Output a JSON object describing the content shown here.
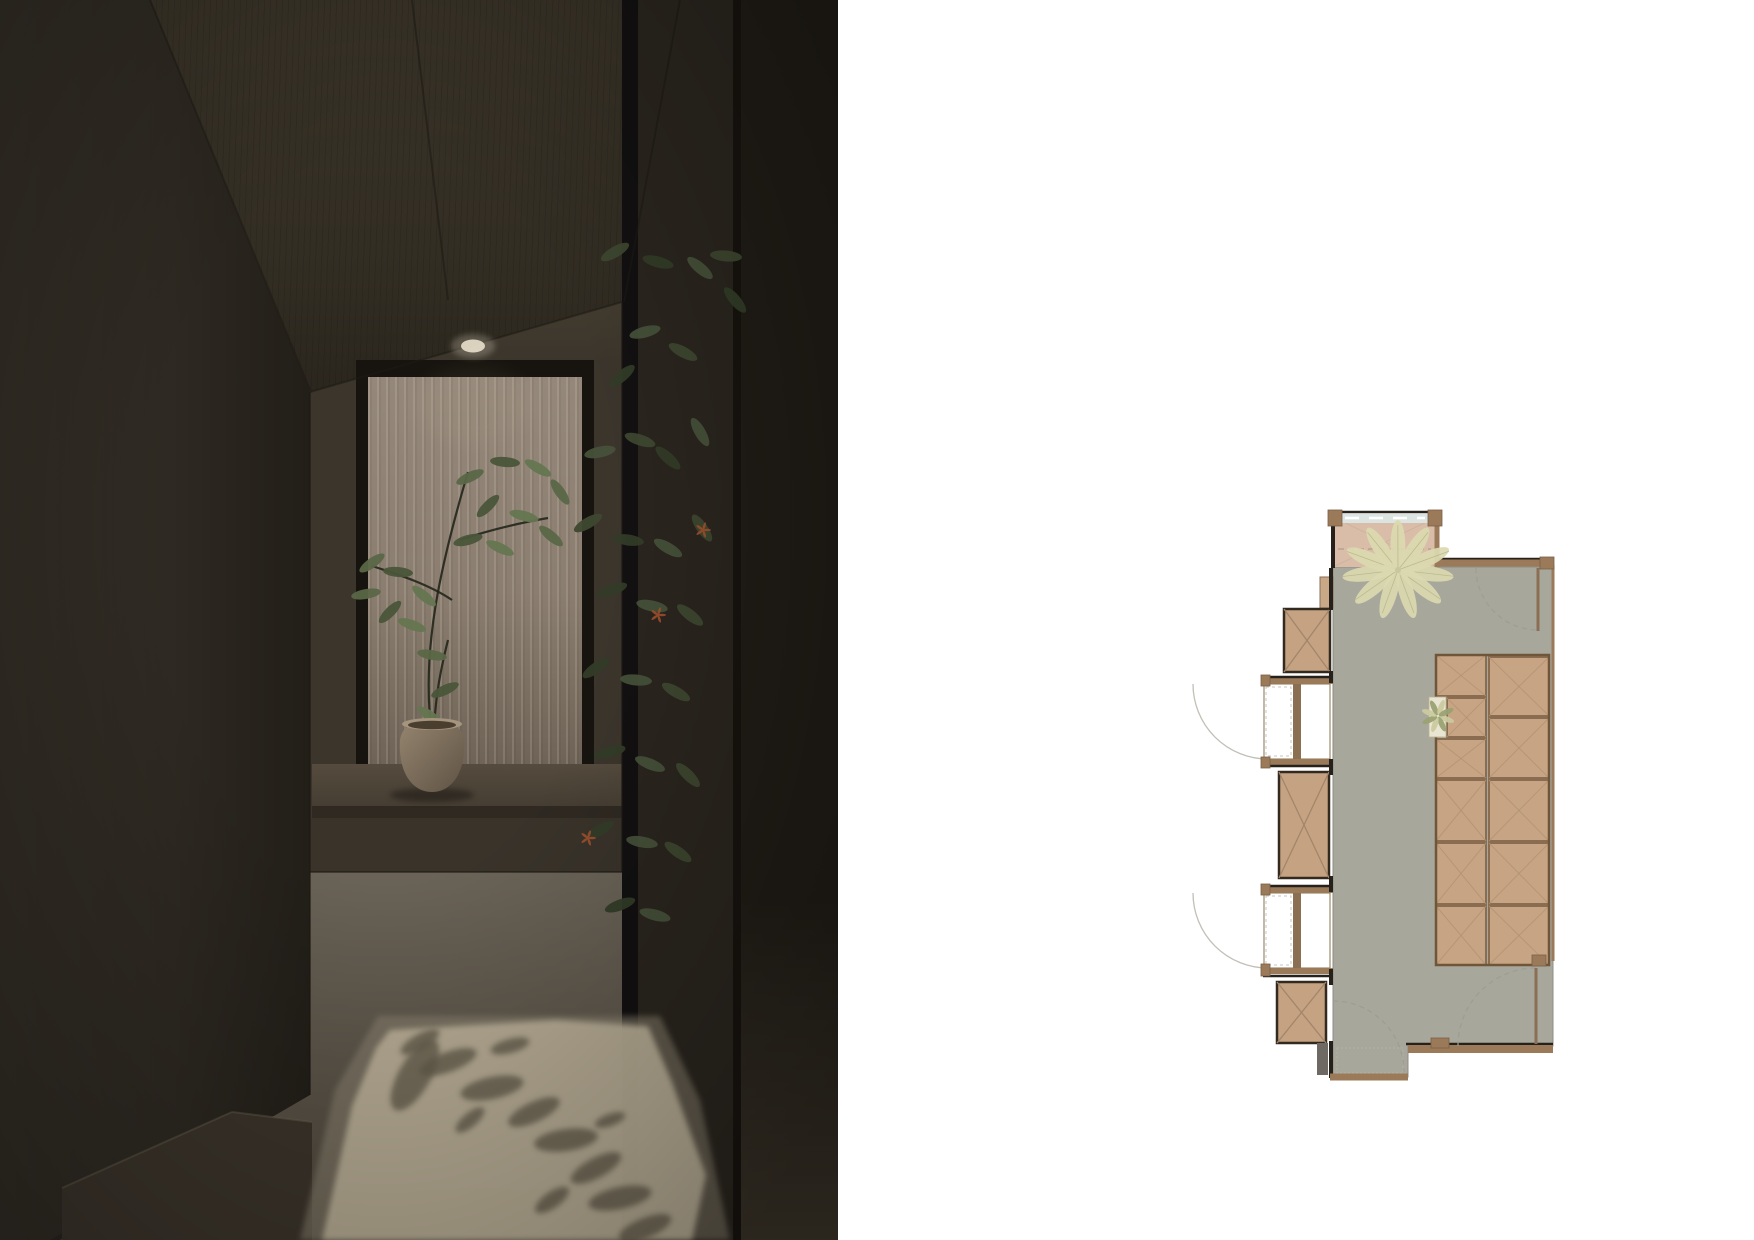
{
  "palette": {
    "plan_floor": "#a8a79c",
    "plan_entry": "#d9bda9",
    "plan_tan": "#c6a484",
    "plan_tan_border": "#8a6d50",
    "plan_block_outline": "#32291f",
    "plan_wall_brown": "#9b7a5a",
    "plan_wall_dark": "#26211b",
    "plan_alcove": "#ffffff",
    "plan_mullion": "#8a6f52",
    "plan_arc": "#c2bfb7",
    "plan_dash": "#a09c93",
    "plan_window_band": "#dce4e1",
    "plan_star_fill": "#dbd9b0",
    "plan_star_stroke": "#b5b384",
    "plan_stub": "#6e6a63",
    "render_lit_patch": "#b9ae96",
    "render_dim_patch": "#8d8472",
    "render_shadow": "#645c4c",
    "render_light": "#e8e0cb",
    "render_pot_light": "#94846f",
    "render_pot_dark": "#605344",
    "render_pot_rim": "#a5947e",
    "render_soil": "#4a3e2f",
    "render_flower": "#a0512c",
    "render_leaf_dark": "#333c28",
    "render_leaf_mid": "#3e4830",
    "render_leaf_light": "#46513a",
    "wplant_a": "#5a6747",
    "wplant_b": "#4a5539",
    "wplant_c": "#657650"
  },
  "render": {
    "size": [
      838,
      1240
    ],
    "downlight": {
      "cx": 473,
      "cy": 346
    },
    "corner_lines": [
      [
        150,
        0,
        310,
        390
      ],
      [
        412,
        0,
        448,
        300
      ],
      [
        680,
        0,
        624,
        302
      ],
      [
        310,
        392,
        622,
        302
      ],
      [
        310,
        392,
        310,
        1095
      ],
      [
        622,
        302,
        622,
        872
      ],
      [
        310,
        872,
        622,
        872
      ]
    ],
    "step_lines": [
      [
        62,
        1188,
        232,
        1112
      ],
      [
        232,
        1112,
        312,
        1122
      ]
    ],
    "dim_patch": "378,1016 660,1016 700,1100 730,1240 300,1240 335,1090",
    "lit_patch": "390,1030 556,1020 648,1026 672,1082 706,1175 692,1240 322,1240 352,1106 376,1048",
    "shadow_blobs": [
      [
        448,
        1062,
        30,
        10,
        -20
      ],
      [
        492,
        1088,
        32,
        11,
        -12
      ],
      [
        534,
        1112,
        28,
        10,
        -25
      ],
      [
        566,
        1140,
        32,
        11,
        -8
      ],
      [
        596,
        1168,
        28,
        10,
        -28
      ],
      [
        620,
        1198,
        32,
        11,
        -12
      ],
      [
        645,
        1228,
        28,
        10,
        -22
      ],
      [
        420,
        1042,
        22,
        8,
        -30
      ],
      [
        510,
        1046,
        20,
        7,
        -15
      ],
      [
        470,
        1120,
        18,
        7,
        -40
      ],
      [
        552,
        1200,
        20,
        8,
        -35
      ],
      [
        610,
        1120,
        16,
        6,
        -20
      ],
      [
        415,
        1075,
        40,
        16,
        -60
      ]
    ],
    "stems": [
      "M432,735 C420,650 442,560 468,472",
      "M452,600 C430,585 400,575 372,566",
      "M460,540 C495,528 525,522 548,518",
      "M448,640 C438,680 436,700 434,726"
    ],
    "window_leaves": [
      [
        470,
        477,
        -25
      ],
      [
        505,
        462,
        5
      ],
      [
        538,
        468,
        30
      ],
      [
        560,
        492,
        55
      ],
      [
        488,
        506,
        -45
      ],
      [
        524,
        516,
        15
      ],
      [
        551,
        536,
        40
      ],
      [
        468,
        540,
        -15
      ],
      [
        500,
        548,
        25
      ],
      [
        372,
        563,
        -35
      ],
      [
        398,
        572,
        5
      ],
      [
        424,
        596,
        40
      ],
      [
        366,
        594,
        -10
      ],
      [
        390,
        612,
        -45
      ],
      [
        412,
        625,
        20
      ],
      [
        432,
        655,
        10
      ],
      [
        445,
        690,
        -25
      ],
      [
        430,
        716,
        35
      ]
    ],
    "pot": {
      "cx": 432,
      "rim_y": 724,
      "bottom_y": 792
    },
    "hanging_leaves": [
      [
        615,
        252,
        -30
      ],
      [
        658,
        262,
        15
      ],
      [
        700,
        268,
        40
      ],
      [
        726,
        256,
        5
      ],
      [
        735,
        300,
        50
      ],
      [
        645,
        332,
        -15
      ],
      [
        683,
        352,
        28
      ],
      [
        622,
        376,
        -40
      ],
      [
        600,
        452,
        -12
      ],
      [
        640,
        440,
        18
      ],
      [
        668,
        458,
        42
      ],
      [
        700,
        432,
        60
      ],
      [
        588,
        523,
        -30
      ],
      [
        628,
        540,
        8
      ],
      [
        668,
        548,
        30
      ],
      [
        702,
        528,
        55
      ],
      [
        612,
        590,
        -20
      ],
      [
        652,
        606,
        12
      ],
      [
        690,
        615,
        38
      ],
      [
        596,
        668,
        -35
      ],
      [
        636,
        680,
        5
      ],
      [
        676,
        692,
        30
      ],
      [
        610,
        752,
        -15
      ],
      [
        650,
        764,
        22
      ],
      [
        688,
        775,
        45
      ],
      [
        600,
        830,
        -30
      ],
      [
        642,
        842,
        10
      ],
      [
        678,
        852,
        35
      ],
      [
        620,
        905,
        -20
      ],
      [
        655,
        915,
        15
      ]
    ],
    "flowers": [
      [
        703,
        530
      ],
      [
        658,
        615
      ],
      [
        588,
        838
      ]
    ]
  },
  "plan": {
    "viewbox": [
      1185,
      495,
      390,
      600
    ],
    "floor_polygon": "1333,567 1553,567 1553,1046 1408,1046 1408,1077 1333,1077",
    "faint_rect": [
      1337,
      1048,
      66,
      25
    ],
    "entry": {
      "rect": [
        1333,
        514,
        104,
        53
      ],
      "window_band": [
        1341,
        514,
        88,
        9
      ],
      "white_dash": [
        1345,
        518,
        1425,
        518
      ],
      "dash_line": [
        1338,
        549,
        1431,
        549
      ],
      "diagonals": [
        [
          1333,
          517,
          1437,
          567
        ],
        [
          1437,
          517,
          1333,
          567
        ]
      ]
    },
    "entry_step": [
      1320,
      577,
      13,
      31
    ],
    "tatami": {
      "frame": [
        1436,
        655,
        113,
        310
      ],
      "left": {
        "x": 1436,
        "w": 50,
        "rows": [
          [
            655,
            696
          ],
          [
            698,
            737
          ],
          [
            739,
            778
          ],
          [
            780,
            841
          ],
          [
            843,
            904
          ],
          [
            906,
            965
          ]
        ],
        "indent_row": 1,
        "indent_x": 1447,
        "indent_w": 39
      },
      "right": {
        "x": 1489,
        "w": 60,
        "rows": [
          [
            657,
            716
          ],
          [
            718,
            778
          ],
          [
            780,
            841
          ],
          [
            843,
            904
          ],
          [
            906,
            965
          ]
        ]
      }
    },
    "plant_patch": [
      1429,
      697,
      17,
      40
    ],
    "small_plant": {
      "cx": 1438,
      "cy": 716
    },
    "blocks": [
      [
        1284,
        609,
        46,
        63
      ],
      [
        1279,
        772,
        50,
        106
      ],
      [
        1277,
        982,
        49,
        61
      ]
    ],
    "alcoves": [
      {
        "x": 1264,
        "w": 66,
        "y": 684,
        "h": 75,
        "arc": "M1193,684 A75 75 0 0 0 1268,759"
      },
      {
        "x": 1264,
        "w": 66,
        "y": 893,
        "h": 75,
        "arc": "M1193,893 A75 75 0 0 0 1268,968"
      }
    ],
    "brown_walls": [
      [
        1437,
        563,
        1549,
        563,
        7
      ],
      [
        1408,
        1049,
        1553,
        1049,
        8
      ],
      [
        1330,
        1077,
        1408,
        1077,
        7
      ],
      [
        1437,
        514,
        1437,
        567,
        5
      ],
      [
        1553,
        565,
        1553,
        961,
        3
      ]
    ],
    "dark_segments": [
      [
        1333,
        512,
        1333,
        568,
        4
      ],
      [
        1331,
        568,
        1331,
        610,
        4
      ],
      [
        1331,
        671,
        1331,
        683,
        4
      ],
      [
        1331,
        759,
        1331,
        775,
        4
      ],
      [
        1331,
        876,
        1331,
        892,
        4
      ],
      [
        1331,
        969,
        1331,
        985,
        4
      ],
      [
        1331,
        1041,
        1331,
        1078,
        4
      ],
      [
        1437,
        559,
        1549,
        559,
        2.5
      ],
      [
        1406,
        1044,
        1553,
        1044,
        2.5
      ],
      [
        1329,
        512,
        1441,
        512,
        2.5
      ],
      [
        1263,
        677,
        1330,
        677,
        2.5
      ],
      [
        1263,
        766,
        1330,
        766,
        2.5
      ],
      [
        1263,
        886,
        1330,
        886,
        2.5
      ],
      [
        1263,
        976,
        1330,
        976,
        2.5
      ]
    ],
    "stub_wall": [
      1317,
      1043,
      11,
      32
    ],
    "caps": [
      [
        1328,
        510,
        14,
        16
      ],
      [
        1428,
        510,
        14,
        16
      ],
      [
        1540,
        557,
        14,
        12
      ],
      [
        1532,
        955,
        14,
        11
      ],
      [
        1431,
        1038,
        18,
        10
      ],
      [
        1261,
        675,
        9,
        11
      ],
      [
        1261,
        757,
        9,
        11
      ],
      [
        1261,
        884,
        9,
        11
      ],
      [
        1261,
        964,
        9,
        12
      ]
    ],
    "doors": {
      "leaves": [
        [
          1538,
          568,
          1538,
          631
        ],
        [
          1536,
          968,
          1536,
          1044
        ]
      ],
      "arcs": [
        "M1476,568 A62 62 0 0 0 1538,630",
        "M1458,1046 A78 78 0 0 1 1536,968",
        "M1333,1001 A71 71 0 0 1 1404,1072"
      ]
    },
    "entry_plant": {
      "cx": 1398,
      "cy": 570,
      "leaf_count": 11,
      "leaf_len": 26,
      "leaf_w": 7.5,
      "dist": 30
    }
  }
}
